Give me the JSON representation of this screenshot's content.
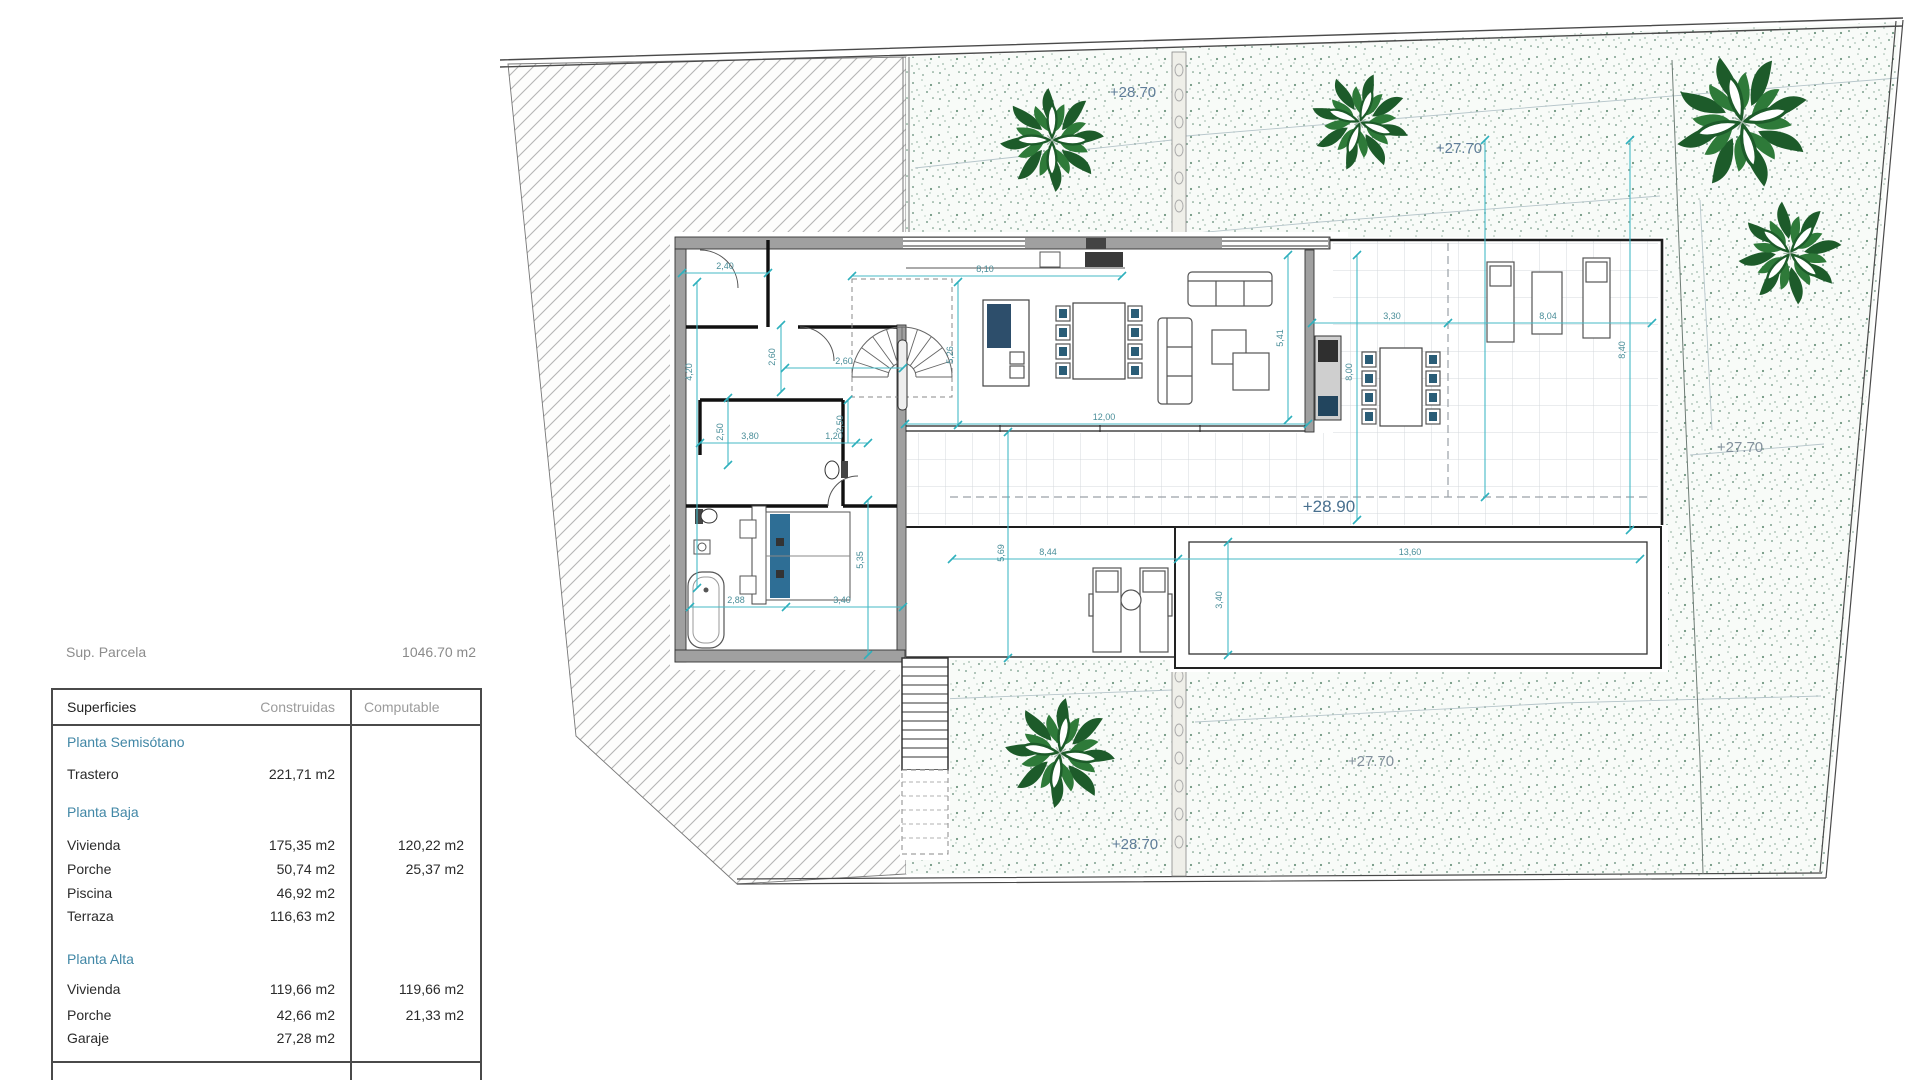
{
  "panel": {
    "parcel_label": "Sup. Parcela",
    "parcel_value": "1046.70 m2",
    "table": {
      "col_headers": {
        "c1": "Superficies",
        "c2": "Construidas",
        "c3": "Computable"
      },
      "sections": [
        {
          "title": "Planta Semisótano",
          "rows": [
            {
              "name": "Trastero",
              "construidas": "221,71 m2",
              "computable": ""
            }
          ]
        },
        {
          "title": "Planta Baja",
          "rows": [
            {
              "name": "Vivienda",
              "construidas": "175,35 m2",
              "computable": "120,22 m2"
            },
            {
              "name": "Porche",
              "construidas": "50,74 m2",
              "computable": "25,37 m2"
            },
            {
              "name": "Piscina",
              "construidas": "46,92 m2",
              "computable": ""
            },
            {
              "name": "Terraza",
              "construidas": "116,63 m2",
              "computable": ""
            }
          ]
        },
        {
          "title": "Planta Alta",
          "rows": [
            {
              "name": "Vivienda",
              "construidas": "119,66 m2",
              "computable": "119,66 m2"
            },
            {
              "name": "Porche",
              "construidas": "42,66 m2",
              "computable": "21,33 m2"
            },
            {
              "name": "Garaje",
              "construidas": "27,28 m2",
              "computable": ""
            }
          ]
        }
      ]
    }
  },
  "plan": {
    "elevations": {
      "top_center": "+28.70",
      "top_right": "+27.70",
      "right": "+27.70",
      "main_floor": "+28.90",
      "bottom_right": "+27.70",
      "bottom_center": "+28.70"
    },
    "dims": {
      "w240": "2,40",
      "w810": "8,10",
      "h420": "4,20",
      "h260": "2,60",
      "w260": "2,60",
      "h526": "5,26",
      "w1200": "12,00",
      "h541": "5,41",
      "w330": "3,30",
      "w804": "8,04",
      "h800": "8,00",
      "h840": "8,40",
      "h250a": "2,50",
      "w380": "3,80",
      "w120": "1,20",
      "h250b": "2,50",
      "w288": "2,88",
      "w340": "3,40",
      "h535": "5,35",
      "w844": "8,44",
      "h569": "5,69",
      "w1360": "13,60",
      "h340": "3,40"
    }
  },
  "colors": {
    "dimension_teal": "#45bac6",
    "dimension_text": "#4a8e99",
    "section_title_blue": "#4187a6",
    "elevation_blue": "#5f7d99",
    "plant_green_dark": "#1d5b2a",
    "plant_green_mid": "#2e7a39"
  }
}
